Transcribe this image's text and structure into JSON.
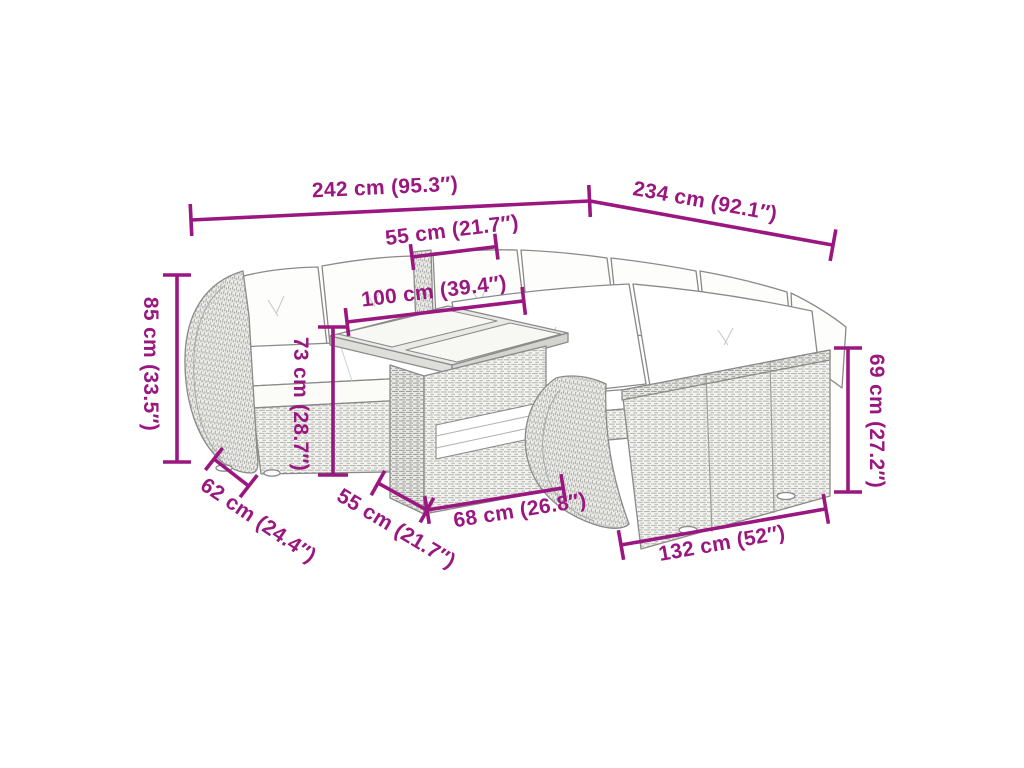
{
  "diagram": {
    "kind": "product-dimension-drawing",
    "subject": "poly-rattan garden lounge set with corner sofa, cushions and lift-top table"
  },
  "colors": {
    "accent": "#9A1780",
    "artwork_outline": "#8A8A8A",
    "rattan_fill": "#F3F3F0",
    "cushion_fill": "#FFFFFF",
    "background": "#FFFFFF"
  },
  "dimensions": {
    "overall_width": {
      "label": "242 cm (95.3″)",
      "value_cm": 242,
      "value_in": 95.3
    },
    "overall_depth": {
      "label": "234 cm (92.1″)",
      "value_cm": 234,
      "value_in": 92.1
    },
    "seat_width_top": {
      "label": "55 cm (21.7″)",
      "value_cm": 55,
      "value_in": 21.7
    },
    "table_length": {
      "label": "100 cm (39.4″)",
      "value_cm": 100,
      "value_in": 39.4
    },
    "backrest_height_left": {
      "label": "85 cm (33.5″)",
      "value_cm": 85,
      "value_in": 33.5
    },
    "table_height": {
      "label": "73 cm (28.7″)",
      "value_cm": 73,
      "value_in": 28.7
    },
    "seat_depth": {
      "label": "62 cm (24.4″)",
      "value_cm": 62,
      "value_in": 24.4
    },
    "seat_width_bottom": {
      "label": "55 cm (21.7″)",
      "value_cm": 55,
      "value_in": 21.7
    },
    "table_depth": {
      "label": "68 cm (26.8″)",
      "value_cm": 68,
      "value_in": 26.8
    },
    "sofa_length_right": {
      "label": "132 cm (52″)",
      "value_cm": 132,
      "value_in": 52
    },
    "backrest_height_right": {
      "label": "69 cm (27.2″)",
      "value_cm": 69,
      "value_in": 27.2
    }
  }
}
